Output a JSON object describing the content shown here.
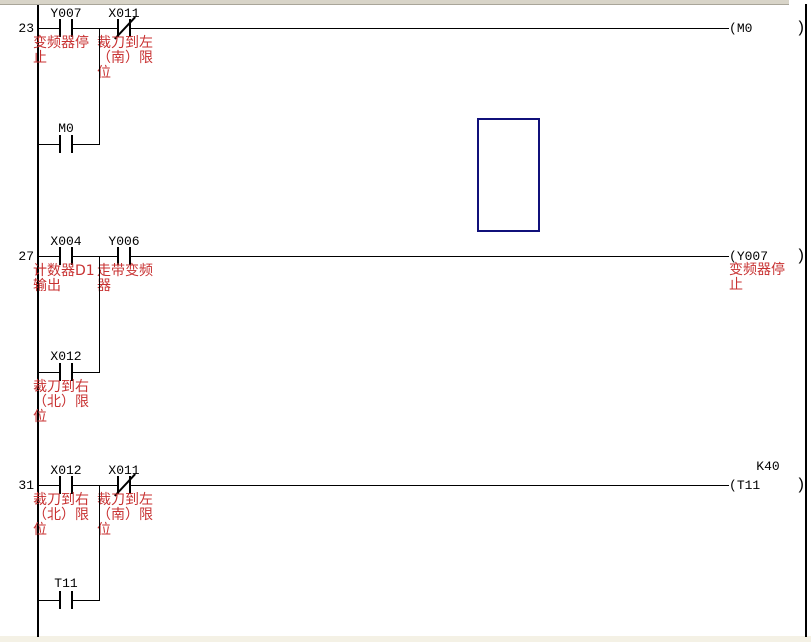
{
  "colors": {
    "background": "#ffffff",
    "wire_black": "#000000",
    "comment_red": "#c83232",
    "cursor_blue": "#10107a",
    "frame_top_beige": "#d8d4c8",
    "frame_bottom_beige": "#f4f1e5"
  },
  "ladder": {
    "rungs": [
      {
        "step": "23",
        "contacts": [
          {
            "device": "Y007",
            "type": "NO",
            "comment": "变频器停止"
          },
          {
            "device": "X011",
            "type": "NC",
            "comment": "裁刀到左（南）限位"
          }
        ],
        "parallel_contact": {
          "device": "M0",
          "type": "NO",
          "comment": ""
        },
        "coil": {
          "device": "M0",
          "operand": "",
          "comment": ""
        }
      },
      {
        "step": "27",
        "contacts": [
          {
            "device": "X004",
            "type": "NO",
            "comment": "计数器D1输出"
          },
          {
            "device": "Y006",
            "type": "NO",
            "comment": "走带变频器"
          }
        ],
        "parallel_contact": {
          "device": "X012",
          "type": "NO",
          "comment": "裁刀到右（北）限位"
        },
        "coil": {
          "device": "Y007",
          "operand": "",
          "comment": "变频器停止"
        }
      },
      {
        "step": "31",
        "contacts": [
          {
            "device": "X012",
            "type": "NO",
            "comment": "裁刀到右（北）限位"
          },
          {
            "device": "X011",
            "type": "NC",
            "comment": "裁刀到左（南）限位"
          }
        ],
        "parallel_contact": {
          "device": "T11",
          "type": "NO",
          "comment": ""
        },
        "coil": {
          "device": "T11",
          "operand": "K40",
          "comment": ""
        }
      }
    ]
  }
}
